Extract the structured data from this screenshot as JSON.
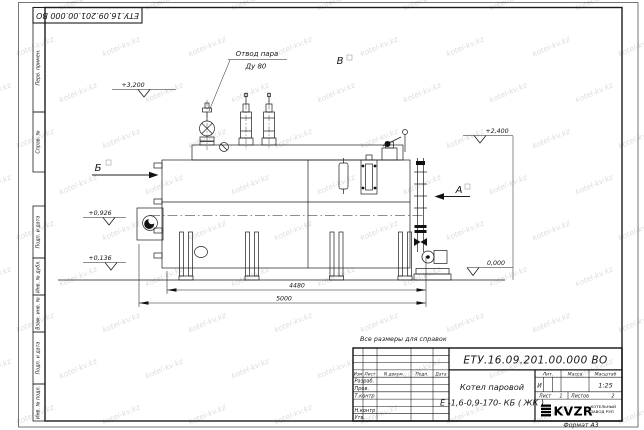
{
  "watermark": {
    "text": "kotel-kv.kz",
    "color": "#d7d7d7"
  },
  "corner_stamp": {
    "doc_number": "ЕТУ.16.09.201.00.000  ВО"
  },
  "margin_labels": {
    "perv_primen": "Перв. примен.",
    "sprav_n": "Справ. №",
    "podp_data_1": "Подп. и дата",
    "inv_dubl": "Инв. № дубл.",
    "vzam_inv": "Взам. инв. №",
    "podp_data_2": "Подп. и дата",
    "inv_podl": "Инв. № подл."
  },
  "drawing": {
    "callout_steam_line1": "Отвод пара",
    "callout_steam_line2": "Ду 80",
    "section_b": "Б",
    "view_v": "В",
    "section_a": "А",
    "elevations": {
      "e1": "+3,200",
      "e2": "+2,400",
      "e3": "+0,926",
      "e4": "+0,136",
      "e5": "0,000"
    },
    "dimensions": {
      "inner": "4480",
      "outer": "5000"
    }
  },
  "note": "Все размеры для справок",
  "title_block": {
    "doc_number": "ЕТУ.16.09.201.00.000  ВО",
    "name_line1": "Котел паровой",
    "name_line2": "Е -1,6-0,9-170- КБ ( ЖК )",
    "cols": {
      "izm": "Изм",
      "list": "Лист",
      "ndoc": "N докум.",
      "podp": "Подп.",
      "data": "Дата"
    },
    "rows": {
      "razrab": "Разраб.",
      "prov": "Пров.",
      "tkontr": "Т.контр",
      "nkontr": "Н.контр",
      "utv": "Утв."
    },
    "lit_label": "Лит.",
    "lit_value": "И",
    "mass_label": "Масса",
    "scale_label": "Масштаб",
    "scale_value": "1:25",
    "sheet_label": "Лист",
    "sheet_value": "1",
    "sheets_label": "Листов",
    "sheets_value": "2",
    "company_logo": "KVZR",
    "company_line1": "КОТЕЛЬНЫЙ",
    "company_line2": "ЗАВОД РЭП",
    "format_label": "Формат  А3"
  }
}
